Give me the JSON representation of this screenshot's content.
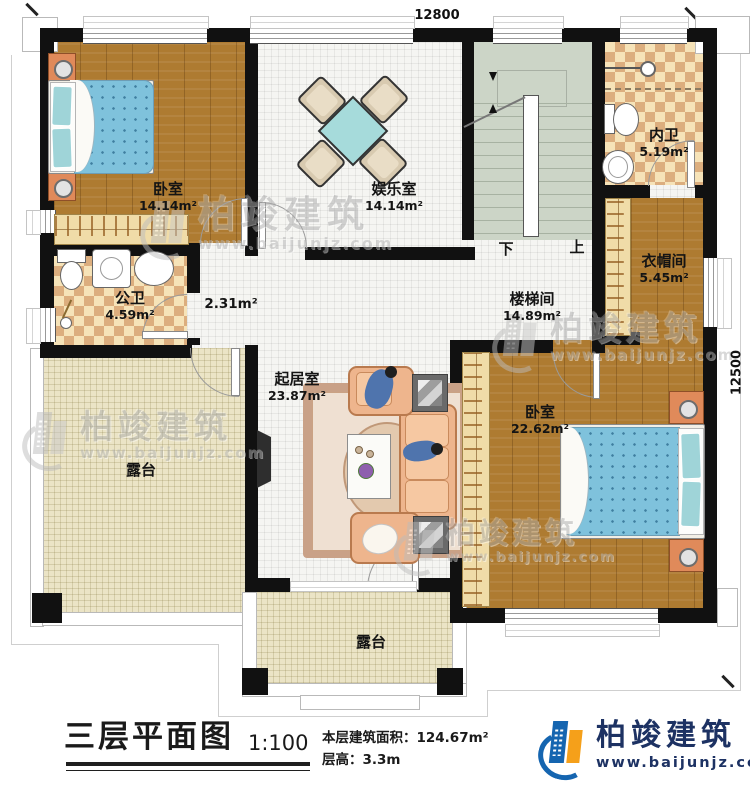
{
  "plan": {
    "dim_top": "12800",
    "dim_right": "12500",
    "stairs_down": "下",
    "stairs_up": "上"
  },
  "rooms": {
    "bedroom1": {
      "name": "卧室",
      "area": "14.14m²"
    },
    "recreation": {
      "name": "娱乐室",
      "area": "14.14m²"
    },
    "ensuite": {
      "name": "内卫",
      "area": "5.19m²"
    },
    "cloakroom": {
      "name": "衣帽间",
      "area": "5.45m²"
    },
    "stairwell": {
      "name": "楼梯间",
      "area": "14.89m²"
    },
    "public_bath": {
      "name": "公卫",
      "area": "4.59m²"
    },
    "hallway": {
      "area": "2.31m²"
    },
    "living_room": {
      "name": "起居室",
      "area": "23.87m²"
    },
    "bedroom2": {
      "name": "卧室",
      "area": "22.62m²"
    },
    "terrace_left": {
      "name": "露台"
    },
    "terrace_bottom": {
      "name": "露台"
    }
  },
  "title_block": {
    "title": "三层平面图",
    "scale": "1:100",
    "floor_area_label": "本层建筑面积：",
    "floor_area_value": "124.67m²",
    "floor_height_label": "层高：",
    "floor_height_value": "3.3m"
  },
  "brand": {
    "name": "柏竣建筑",
    "url": "www.baijunjz.com"
  },
  "colors": {
    "wall": "#111111",
    "wood_floor": "#ae7b31",
    "tile_floor": "#f5f5f2",
    "bath_tile_tan": "#dcae7e",
    "bath_tile_cream": "#f6e3b8",
    "stair_floor": "#ccd5c7",
    "terrace_floor": "#ebe4c6",
    "bed_blue": "#7fc2dc",
    "sofa_peach": "#eeb58d",
    "brand_navy": "#1d3263",
    "brand_blue": "#1565b0",
    "brand_orange": "#f5a01a"
  }
}
